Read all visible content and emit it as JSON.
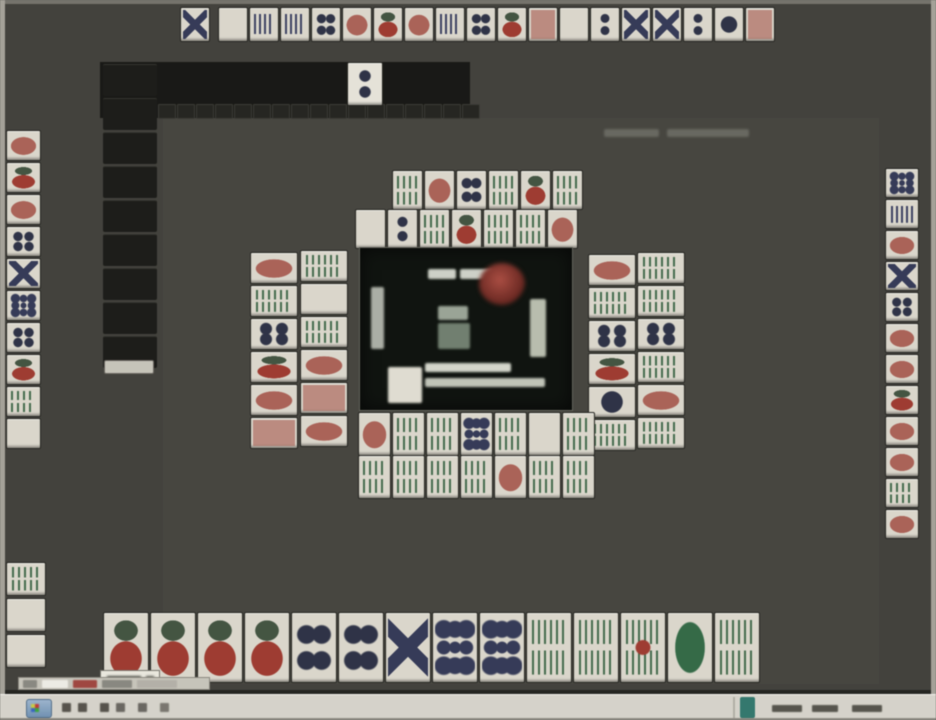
{
  "window": {
    "background": "#41403a",
    "edge_color": "#a5a298",
    "dark_zone_color": "#161613",
    "tile_face_color": "#ddd9cc"
  },
  "top_hand": {
    "lone_tile": [
      "pinX"
    ],
    "tiles": [
      "haku",
      "pinbar",
      "pinbar",
      "pin4",
      "manr",
      "man",
      "manr",
      "pinbar",
      "pin4",
      "man",
      "red",
      "haku",
      "pin2",
      "pinX",
      "pinX",
      "pin2",
      "pin1",
      "red"
    ]
  },
  "walls": {
    "left_column_backs": 9,
    "top_mini_backs": 17
  },
  "dora_indicator": {
    "tiles": [
      "pin2"
    ]
  },
  "left_hand": {
    "tiles": [
      "manr",
      "man",
      "manr",
      "pin4",
      "pinX",
      "pin9",
      "pin4",
      "man",
      "sou",
      "haku"
    ]
  },
  "right_hand": {
    "tiles": [
      "pin9",
      "pinbar",
      "manr",
      "pinX",
      "pin4",
      "manr",
      "manr",
      "man",
      "manr",
      "manr",
      "sou",
      "manr"
    ]
  },
  "discards": {
    "top_row1": [
      "sou",
      "manr",
      "pin4",
      "sou",
      "man",
      "sou"
    ],
    "top_row2": [
      "haku",
      "pin2",
      "sou",
      "man",
      "sou",
      "sou",
      "manr"
    ],
    "left_col1": [
      "manr",
      "sou",
      "pin4",
      "man",
      "manr",
      "red"
    ],
    "left_col2": [
      "sou",
      "haku",
      "sou",
      "manr",
      "red",
      "manr"
    ],
    "right_col1": [
      "manr",
      "sou",
      "pin4",
      "man",
      "pin1",
      "sou"
    ],
    "right_col2": [
      "sou",
      "sou",
      "pin4",
      "sou",
      "manr",
      "sou"
    ],
    "bottom_row1": [
      "manr",
      "sou",
      "sou",
      "pin9",
      "sou",
      "haku",
      "sou"
    ],
    "bottom_row2": [
      "sou",
      "sou",
      "sou",
      "sou",
      "manr",
      "sou",
      "sou"
    ]
  },
  "melds_corner": {
    "tiles": [
      "sou",
      "haku",
      "haku"
    ]
  },
  "player_hand": {
    "tiles": [
      "man",
      "man",
      "man",
      "man",
      "pin4",
      "pin4",
      "pinX",
      "pin9",
      "pin9",
      "sou",
      "sou",
      "sou5",
      "hatsu",
      "sou"
    ]
  },
  "center_panel": {
    "dealer_marker_color": "#a23b31",
    "panel_color": "#0c110c"
  },
  "taskbar": {
    "color": "#d8d5cb",
    "start_button_color": "#7a9cbe",
    "tray_icon_color": "#2c7a6e"
  }
}
